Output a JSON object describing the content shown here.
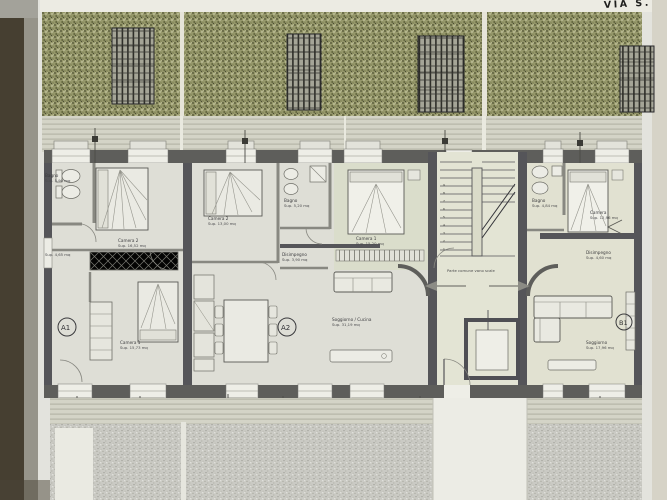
{
  "street_label": "VIA S.",
  "common_label": "Parte comune vano scale",
  "badges": {
    "a1": "A1",
    "a2": "A2",
    "b1": "B1"
  },
  "stairs": {
    "steps": [
      "1",
      "2",
      "3",
      "4",
      "5",
      "6",
      "7",
      "8",
      "9"
    ]
  },
  "rooms": {
    "a1_bagno_name": "Bagno",
    "a1_bagno_area": "Sup. 5,90 mq",
    "a1_camera2_name": "Camera 2",
    "a1_camera2_area": "Sup. 16,52 mq",
    "a1_disimpegno_area": "Sup. 4,65 mq",
    "a1_camera1_name": "Camera 1",
    "a1_camera1_area": "Sup. 15,73 mq",
    "a2_camera2_name": "Camera 2",
    "a2_camera2_area": "Sup. 13,00 mq",
    "a2_bagno_name": "Bagno",
    "a2_bagno_area": "Sup. 5,20 mq",
    "a2_disimpegno_name": "Disimpegno",
    "a2_disimpegno_area": "Sup. 3,90 mq",
    "a2_camera1_name": "Camera 1",
    "a2_camera1_area": "Sup. 15,20 mq",
    "a2_soggiorno_name": "Soggiorno / Cucina",
    "a2_soggiorno_area": "Sup. 31,19 mq",
    "b1_bagno_name": "Bagno",
    "b1_bagno_area": "Sup. 4,84 mq",
    "b1_camera_name": "Camera",
    "b1_camera_area": "Sup. 12,96 mq",
    "b1_disimpegno_name": "Disimpegno",
    "b1_disimpegno_area": "Sup. 4,60 mq",
    "b1_soggiorno_name": "Soggiorno",
    "b1_soggiorno_area": "Sup. 17,96 mq"
  },
  "colors": {
    "garden": "#97996a",
    "facade_wall": "#5e5e5c",
    "paper": "#e9e9e3",
    "stair_floor": "#e9ead9"
  }
}
